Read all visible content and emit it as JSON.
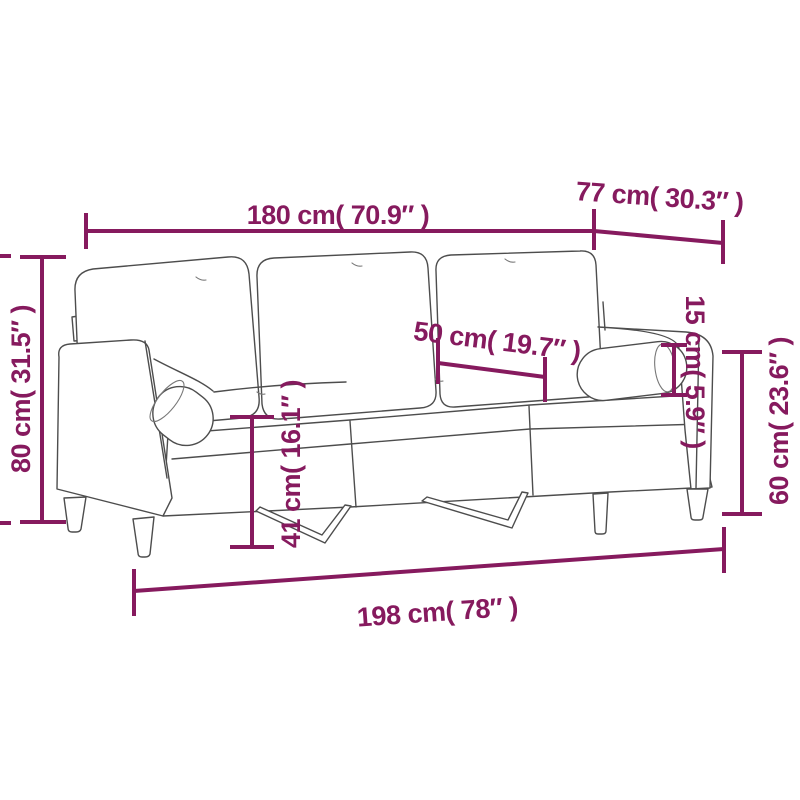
{
  "style": {
    "background": "#ffffff",
    "dimension_color": "#861A5E",
    "sofa_outline_color": "#4d4d4d"
  },
  "diagram": {
    "subject": "3-seater sofa with bolster pillows, line drawing with dimension annotations",
    "labels": {
      "top_width": "180 cm( 70.9″ )",
      "depth": "77 cm( 30.3″ )",
      "back_height": "80 cm( 31.5″ )",
      "seat_depth": "50 cm( 19.7″ )",
      "bolster_diameter": "15 cm( 5.9″ )",
      "arm_height": "60 cm( 23.6″ )",
      "seat_height": "41 cm( 16.1″ )",
      "total_width": "198 cm( 78″ )"
    }
  }
}
